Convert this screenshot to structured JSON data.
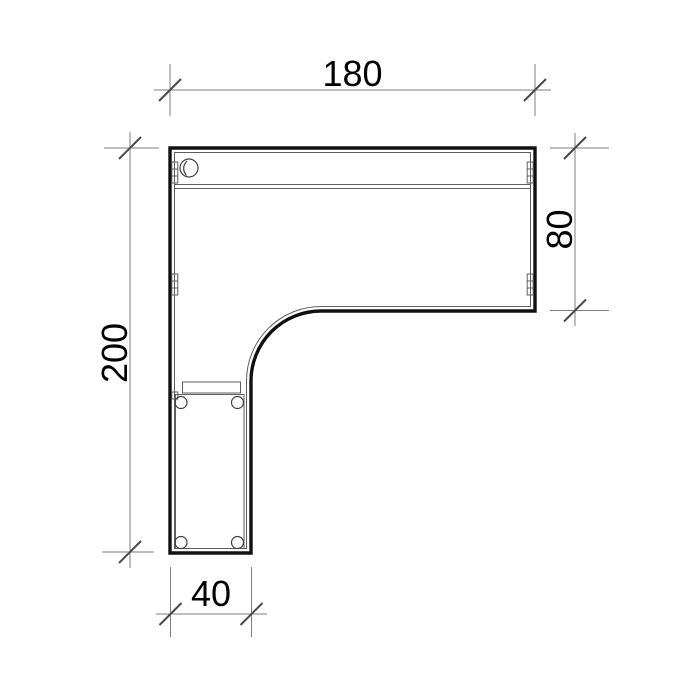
{
  "drawing": {
    "kind": "desk-plan-technical-drawing",
    "dimensions": {
      "top": {
        "value": "180"
      },
      "right": {
        "value": "80"
      },
      "left": {
        "value": "200"
      },
      "bottom": {
        "value": "40"
      }
    },
    "colors": {
      "background": "#ffffff",
      "outline": "#111111",
      "detail_lines": "#5f5f5f",
      "dimension_lines": "#7f7f7f",
      "tick_marks": "#4a4a4a",
      "text": "#000000"
    }
  }
}
